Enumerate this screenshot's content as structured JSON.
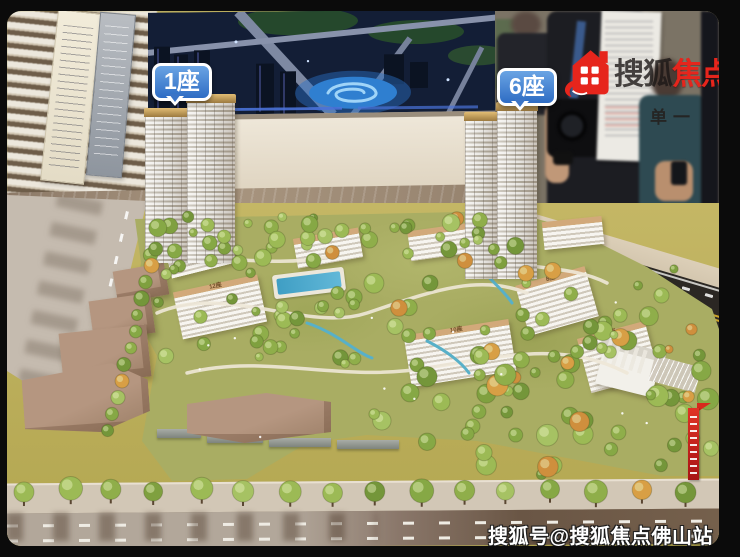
{
  "scene": {
    "labels": {
      "tower1": "1座",
      "tower6": "6座"
    },
    "building_labels": [
      "12座",
      "8座",
      "10座",
      "9座"
    ]
  },
  "watermark_top": {
    "brand_black": "搜狐",
    "brand_red": "焦点",
    "sub": "单一"
  },
  "watermark_bottom": {
    "text": "搜狐号@搜狐焦点佛山站"
  },
  "colors": {
    "sohu_red": "#e6251c",
    "bubble_blue": "#2e6cc4",
    "model_ground_olive": "#b9ad5e",
    "tower_crown_gold": "#c9a35b",
    "banner_red": "#c41e1e"
  }
}
